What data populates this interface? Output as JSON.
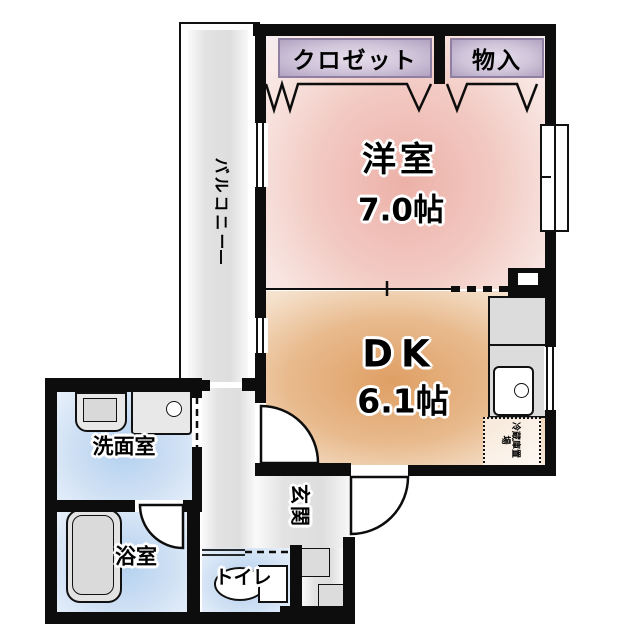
{
  "plan": {
    "balcony": {
      "label": "バルコニー"
    },
    "closet": {
      "label": "クロゼット"
    },
    "storage": {
      "label": "物入"
    },
    "western_room": {
      "name": "洋室",
      "area": "7.0帖"
    },
    "dining_kitchen": {
      "name": "DK",
      "area": "6.1帖"
    },
    "washroom": {
      "label": "洗面室"
    },
    "bathroom": {
      "label": "浴室"
    },
    "toilet": {
      "label": "トイレ"
    },
    "entrance": {
      "label": "玄関"
    },
    "refrigerator_space": {
      "label": "冷蔵庫置場"
    }
  },
  "colors": {
    "wall": "#0d0d0d",
    "western_room_fill": "#ecb1a8",
    "dining_kitchen_fill": "#df9f64",
    "wet_room_fill": "#b3d1ef",
    "closet_label_box": "#cfc4d9",
    "floor_gray": "#e2e2e2"
  }
}
